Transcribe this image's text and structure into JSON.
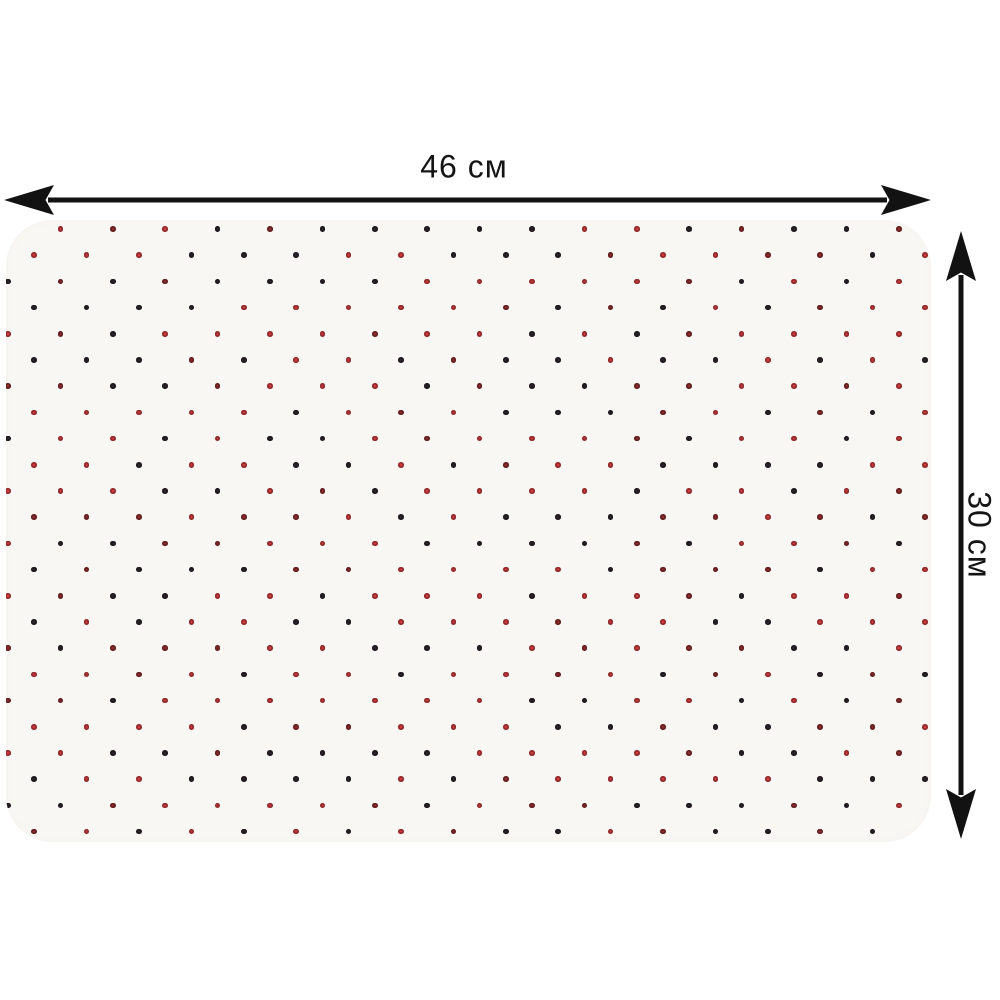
{
  "product_diagram": {
    "type": "placemat-dimension-diagram",
    "width_dimension": {
      "label": "46 см",
      "value": 46,
      "unit": "см"
    },
    "height_dimension": {
      "label": "30 см",
      "value": 30,
      "unit": "см"
    }
  },
  "colors": {
    "page_background": "#ffffff",
    "mat_background": "#f9f7f4",
    "arrow": "#121212",
    "label_text": "#141414",
    "dot_red": "#cd3b3e",
    "dot_dark_red": "#8d2b2d",
    "dot_black": "#2c2329"
  },
  "pattern": {
    "type": "polka-dots",
    "origin_x": 2,
    "origin_y": 9,
    "spacing_x": 52.4,
    "spacing_y": 26.2,
    "row_offset": 26.2,
    "dot_diameter": 5.6,
    "seed": 20,
    "color_weights": {
      "dot_red": 0.44,
      "dot_dark_red": 0.2,
      "dot_black": 0.36
    }
  }
}
